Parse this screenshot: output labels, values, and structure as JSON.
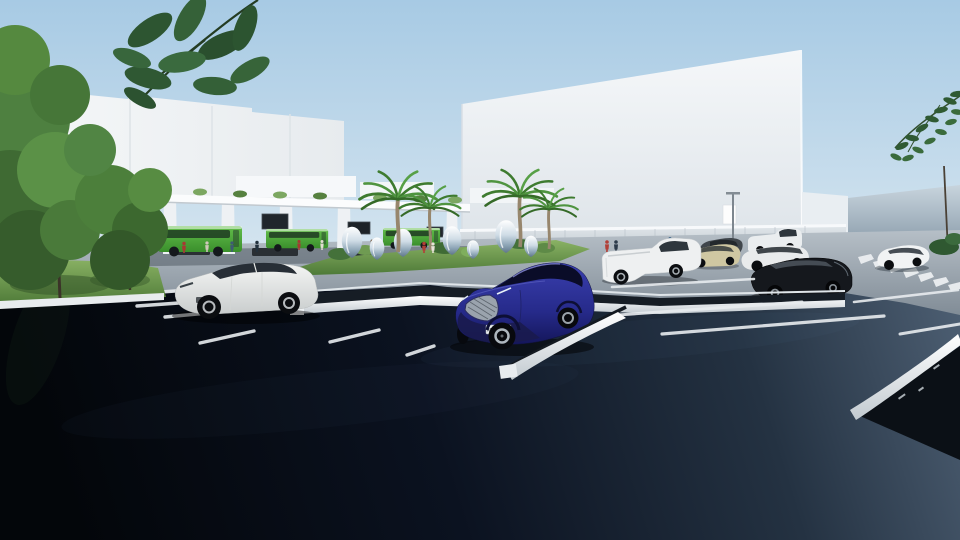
{
  "scene": {
    "title": "Architectural 3D rendering of a shopping-center parking lot with bus terminal",
    "time_of_day": "day, clear sky",
    "license_plate": "AB 123 AR",
    "palette": {
      "skyTop": "#a7cae4",
      "skyHorizon": "#e9f1f6",
      "building": "#f2f5f7",
      "lowWall": "#c3ccd4",
      "road": "#9aa5af",
      "asphaltDark": "#04070c",
      "asphaltLight": "#4d6075",
      "busGreen": "#4ca83a",
      "carBlue": "#2b2f96",
      "grass": "#6f9c52",
      "palmGreen": "#4e8f3c",
      "chrome": "#c3d2dd",
      "lineWhite": "#eef1f3"
    },
    "objects": {
      "buildings": [
        "left retail building with panel seams",
        "large white big-box building",
        "rear annex",
        "low perimeter wall"
      ],
      "bus_terminal": {
        "canopy": "white canopy with roof planters",
        "buses": 3,
        "bus_color": "green",
        "info_screens": 3
      },
      "sculpture_garden": {
        "type": "chrome egg sculptures",
        "count": 7,
        "palm_trees": 4,
        "bushes": 6
      },
      "vehicles": [
        {
          "type": "suv",
          "color": "dark blue",
          "position": "center foreground",
          "license_plate": "AB 123 AR"
        },
        {
          "type": "sedan",
          "color": "white",
          "position": "left foreground"
        },
        {
          "type": "pickup",
          "color": "white",
          "position": "right far row"
        },
        {
          "type": "sedan",
          "color": "beige",
          "position": "right far row"
        },
        {
          "type": "sedan",
          "color": "dark gray",
          "position": "right far row"
        },
        {
          "type": "pickup",
          "color": "white",
          "position": "far right row"
        },
        {
          "type": "suv",
          "color": "white",
          "position": "right near row"
        },
        {
          "type": "sedan",
          "color": "black",
          "position": "right near row"
        },
        {
          "type": "sedan",
          "color": "white",
          "position": "driving on right road"
        }
      ],
      "people_count_approx": 17,
      "crosswalk": true,
      "parking_lines": true,
      "raised_curb_islands": 3
    }
  }
}
